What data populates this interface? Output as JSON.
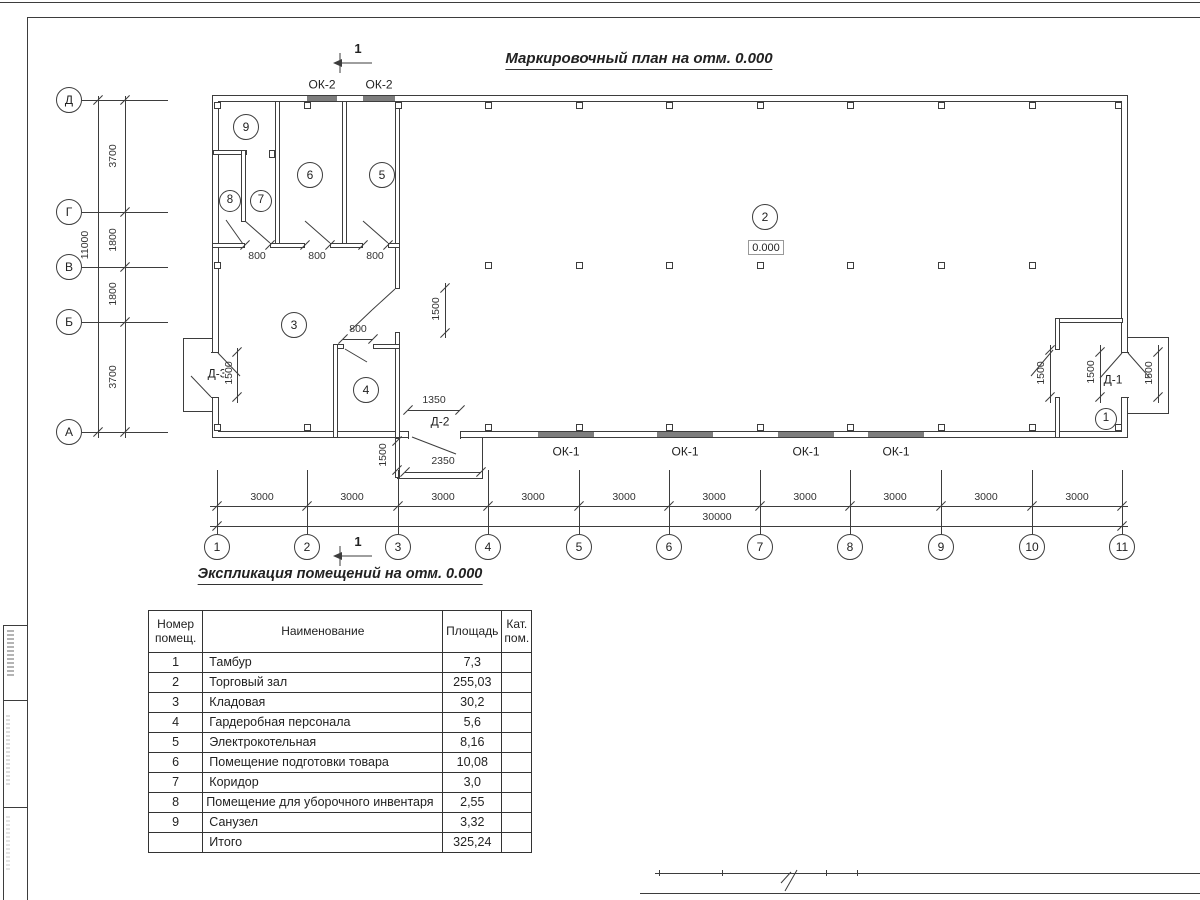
{
  "plan": {
    "title": "Маркировочный план на отм. 0.000",
    "section_label": "1",
    "level_mark": "0.000",
    "axis_rows": [
      "Д",
      "Г",
      "В",
      "Б",
      "А"
    ],
    "axis_cols": [
      "1",
      "2",
      "3",
      "4",
      "5",
      "6",
      "7",
      "8",
      "9",
      "10",
      "11"
    ],
    "dims": {
      "row_total": "11000",
      "row_segments": [
        "3700",
        "1800",
        "1800",
        "3700"
      ],
      "col_segment": "3000",
      "col_total": "30000",
      "door_width": "800",
      "opening_1500": "1500",
      "d2_width": "1350",
      "d2_porch": "2350"
    },
    "windows": {
      "top_label": "ОК-2",
      "bottom_label": "ОК-1"
    },
    "doors": {
      "d1": "Д-1",
      "d2": "Д-2",
      "d3": "Д-3"
    },
    "room_markers": [
      "1",
      "2",
      "3",
      "4",
      "5",
      "6",
      "7",
      "8",
      "9"
    ]
  },
  "schedule": {
    "title": "Экспликация помещений на отм. 0.000",
    "headers": {
      "num": "Номер помещ.",
      "name": "Наименование",
      "area": "Площадь",
      "cat": "Кат. пом."
    },
    "rows": [
      {
        "num": "1",
        "name": "Тамбур",
        "area": "7,3",
        "cat": ""
      },
      {
        "num": "2",
        "name": "Торговый зал",
        "area": "255,03",
        "cat": ""
      },
      {
        "num": "3",
        "name": "Кладовая",
        "area": "30,2",
        "cat": ""
      },
      {
        "num": "4",
        "name": "Гардеробная персонала",
        "area": "5,6",
        "cat": ""
      },
      {
        "num": "5",
        "name": "Электрокотельная",
        "area": "8,16",
        "cat": ""
      },
      {
        "num": "6",
        "name": "Помещение подготовки товара",
        "area": "10,08",
        "cat": ""
      },
      {
        "num": "7",
        "name": "Коридор",
        "area": "3,0",
        "cat": ""
      },
      {
        "num": "8",
        "name": "Помещение для уборочного инвентаря",
        "area": "2,55",
        "cat": ""
      },
      {
        "num": "9",
        "name": "Санузел",
        "area": "3,32",
        "cat": ""
      }
    ],
    "total": {
      "label": "Итого",
      "area": "325,24"
    }
  }
}
